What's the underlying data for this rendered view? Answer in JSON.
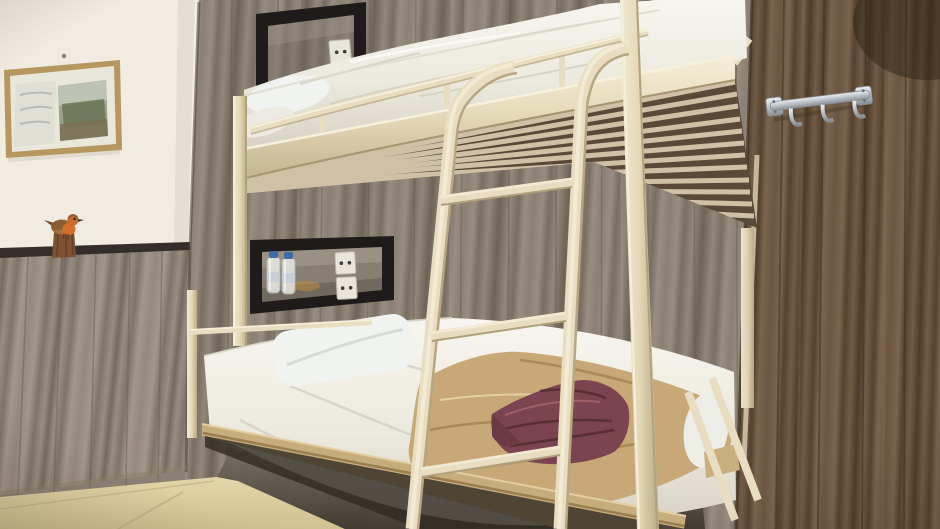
{
  "scene": {
    "type": "photograph",
    "setting": "hostel bedroom with a cream metal bunk bed, wood panelled walls and tiled floor",
    "objects": {
      "bunk_bed": "cream metal bunk bed frame",
      "top_bunk": "white mattress, rumpled duvet and pillow",
      "bottom_bunk": "white mattress with white pillow, tan blanket and folded maroon blanket",
      "ladder": "cream metal ladder with three rungs at the foot of the bed",
      "upper_wall_niche": "black framed wall recess with power outlets",
      "lower_wall_niche": "black framed wall recess holding two water bottles and power outlets",
      "picture_frame": "thin gold framed landscape print on the white wall",
      "bird_figurine": "small robin figurine on a wooden stump on the dado rail",
      "coat_hook_rail": "chrome hook rail on the right wood wall",
      "walls": "grey-brown vertical wood planks; white painted wall with wood wainscot on the left",
      "floor": "beige ceramic floor tiles"
    }
  },
  "colors": {
    "wall-white": "#f0ece2",
    "wood-back": "#8b8074",
    "wood-left": "#94897c",
    "wood-right": "#64513d",
    "trim-dark": "#332e29",
    "bed-cream": "#e8ddc0",
    "bed-cream-dark": "#b6a681",
    "mattress-white": "#efece4",
    "pillow-white": "#f1f3f0",
    "blanket-tan": "#c7a876",
    "blanket-tan-shadow": "#a3824e",
    "blanket-maroon": "#7c4350",
    "blanket-maroon-dark": "#572c35",
    "niche-black": "#1e1b1a",
    "outlet-white": "#e9e5da",
    "bottle-cap-blue": "#3c6ba8",
    "floor-tile": "#d9cb9b",
    "underside-brown": "#5a4938",
    "slat-cream": "#d9cdb0",
    "chrome": "#c6cbd0",
    "frame-gold": "#b5975f",
    "bird-orange": "#d3702c",
    "bird-brown": "#8a5c33",
    "stump-brown": "#7d5333"
  }
}
